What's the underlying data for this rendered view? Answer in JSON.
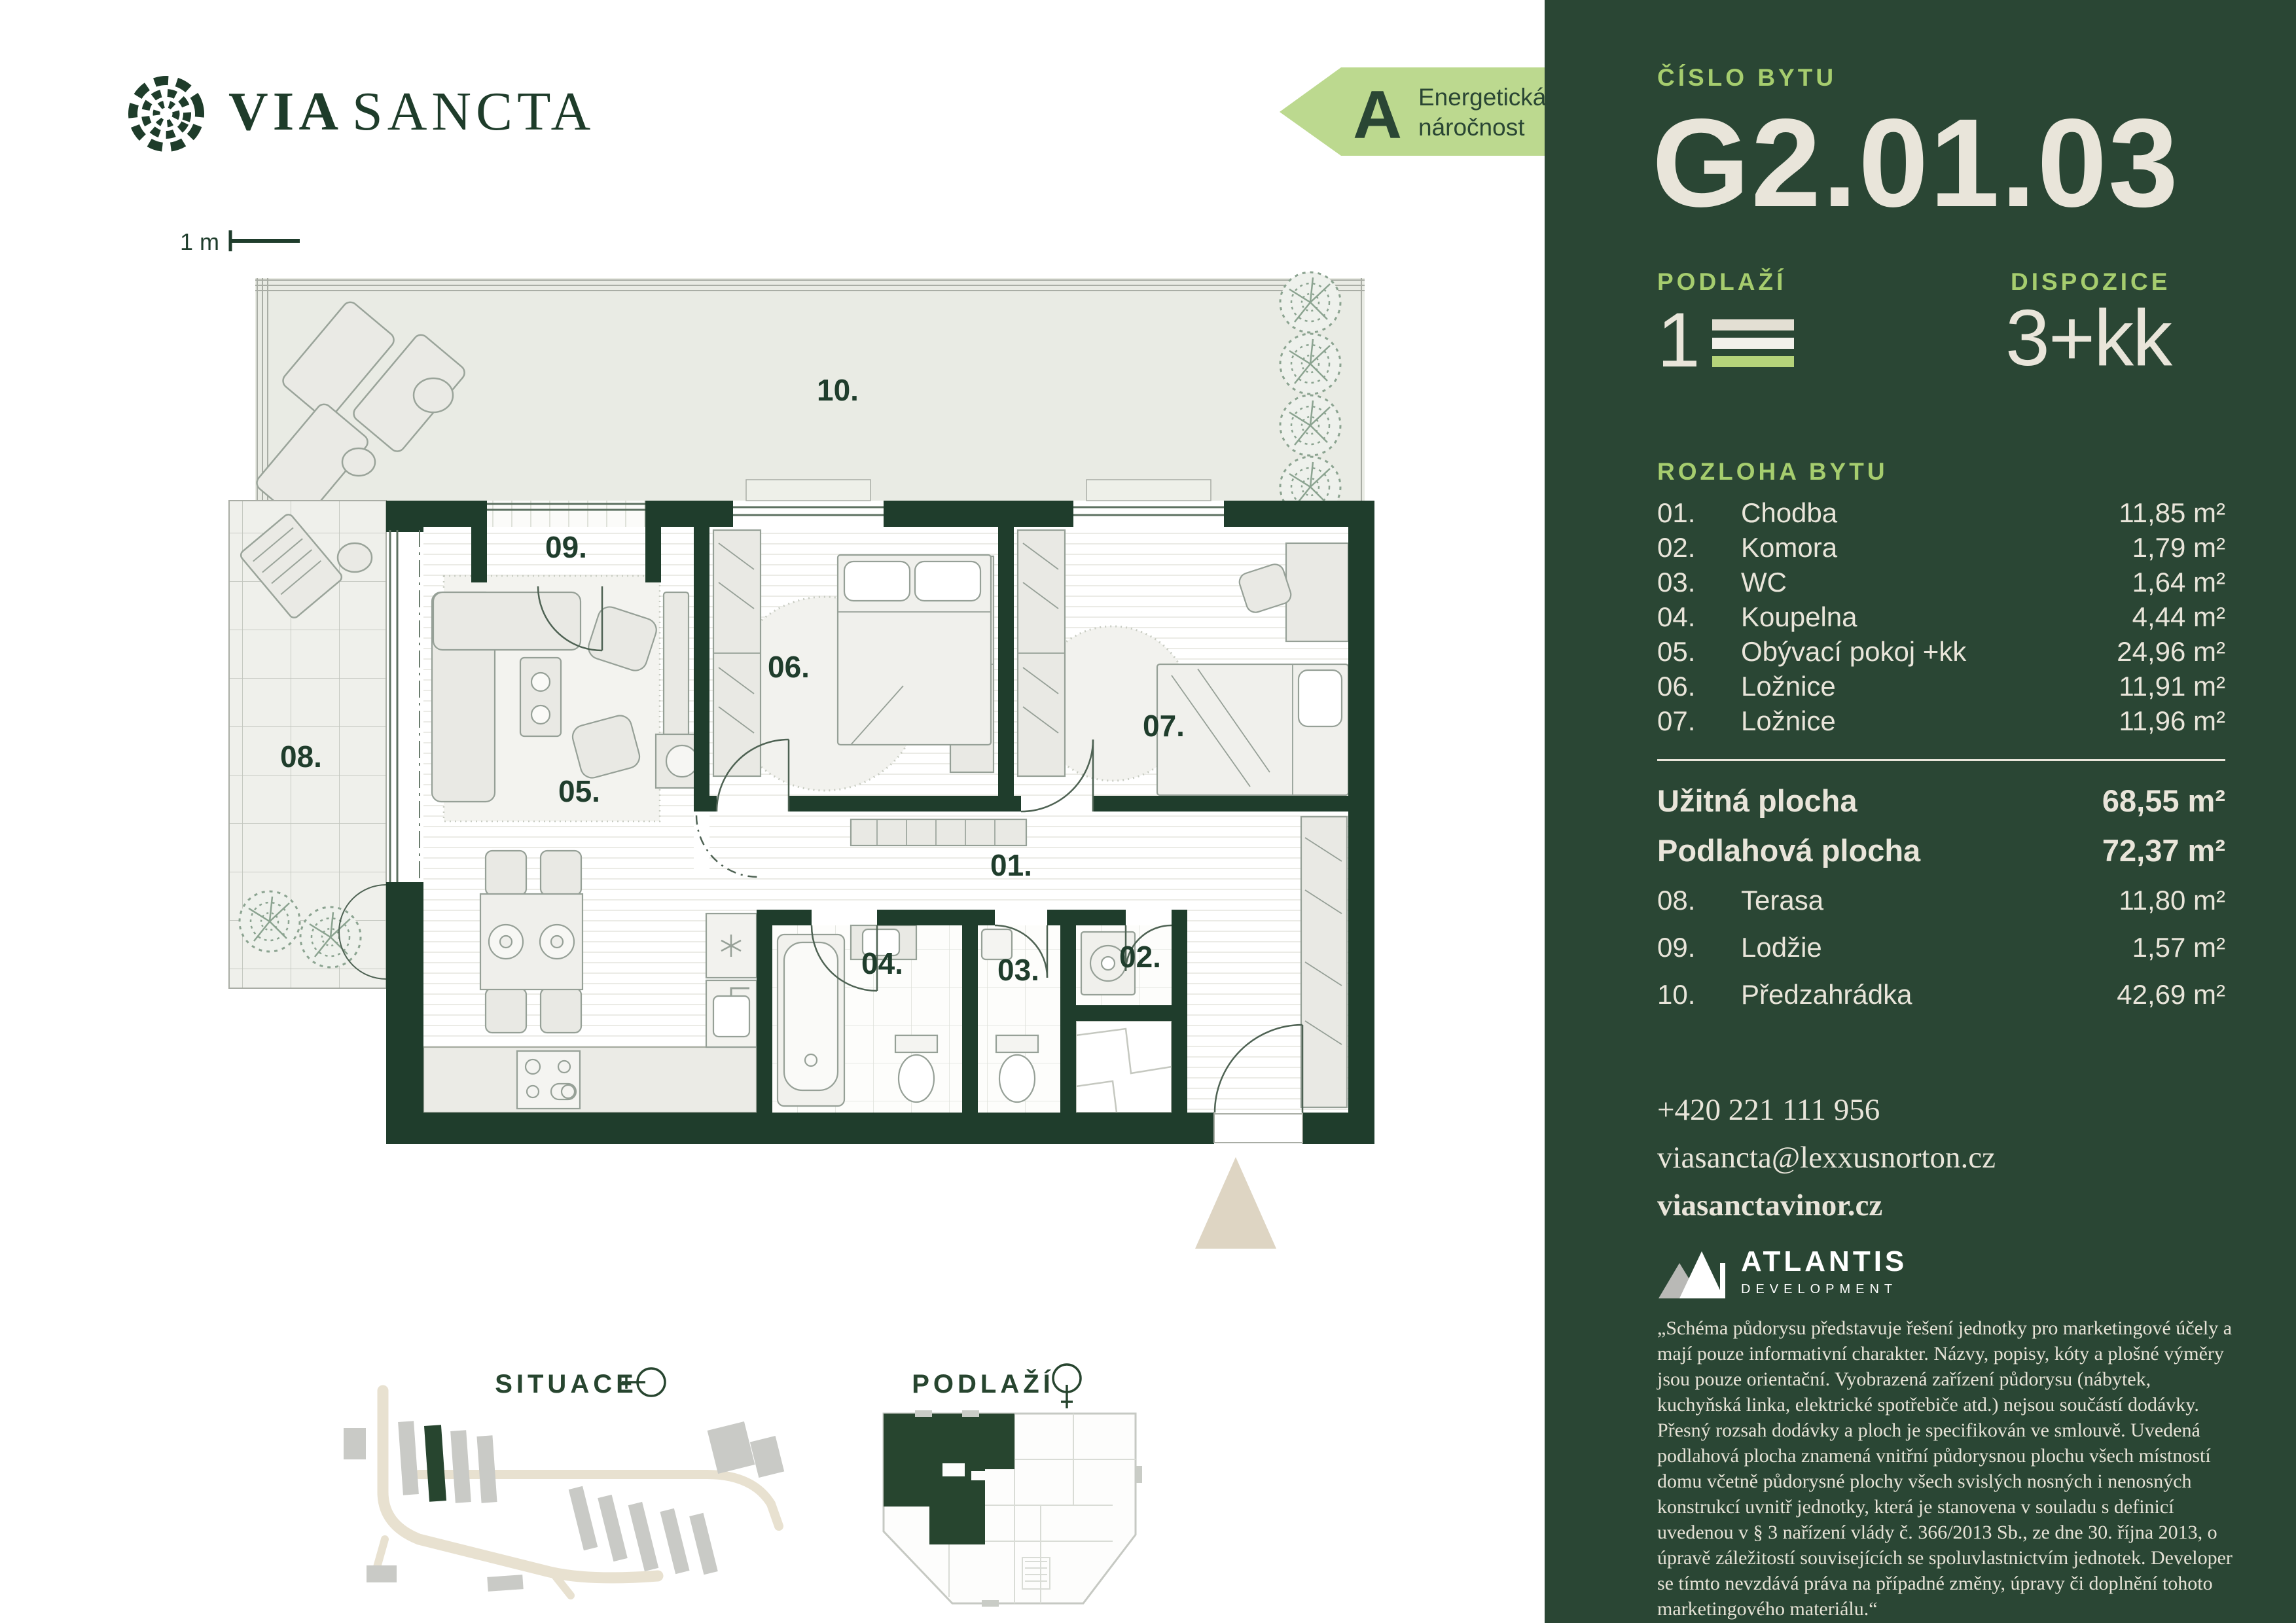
{
  "brand": {
    "word1": "VIA",
    "word2": "SANCTA"
  },
  "energy": {
    "grade": "A",
    "line1": "Energetická",
    "line2": "náročnost"
  },
  "scale_bar": "1 m",
  "plan": {
    "l01": "01.",
    "l02": "02.",
    "l03": "03.",
    "l04": "04.",
    "l05": "05.",
    "l06": "06.",
    "l07": "07.",
    "l08": "08.",
    "l09": "09.",
    "l10": "10."
  },
  "sections": {
    "situace": "SITUACE",
    "podlazi": "PODLAŽÍ"
  },
  "panel": {
    "unit_label": "ČÍSLO BYTU",
    "unit_number": "G2.01.03",
    "floor_label": "PODLAŽÍ",
    "floor_value": "1",
    "layout_label": "DISPOZICE",
    "layout_value": "3+kk",
    "area_label": "ROZLOHA BYTU",
    "rooms": [
      {
        "num": "01.",
        "name": "Chodba",
        "area": "11,85 m²"
      },
      {
        "num": "02.",
        "name": "Komora",
        "area": "1,79 m²"
      },
      {
        "num": "03.",
        "name": "WC",
        "area": "1,64 m²"
      },
      {
        "num": "04.",
        "name": "Koupelna",
        "area": "4,44 m²"
      },
      {
        "num": "05.",
        "name": "Obývací pokoj +kk",
        "area": "24,96 m²"
      },
      {
        "num": "06.",
        "name": "Ložnice",
        "area": "11,91 m²"
      },
      {
        "num": "07.",
        "name": "Ložnice",
        "area": "11,96 m²"
      }
    ],
    "usable": {
      "label": "Užitná plocha",
      "value": "68,55 m²"
    },
    "floor_area": {
      "label": "Podlahová plocha",
      "value": "72,37 m²"
    },
    "exterior": [
      {
        "num": "08.",
        "name": "Terasa",
        "area": "11,80 m²"
      },
      {
        "num": "09.",
        "name": "Lodžie",
        "area": "1,57 m²"
      },
      {
        "num": "10.",
        "name": "Předzahrádka",
        "area": "42,69 m²"
      }
    ],
    "contact": {
      "phone": "+420 221 111 956",
      "email": "viasancta@lexxusnorton.cz",
      "web": "viasanctavinor.cz"
    },
    "developer": {
      "name": "ATLANTIS",
      "subtitle": "DEVELOPMENT"
    },
    "disclaimer": "„Schéma půdorysu představuje řešení jednotky pro marketingové účely a mají pouze informativní charakter. Názvy, popisy, kóty a plošné výměry jsou pouze orientační. Vyobrazená zařízení půdorysu (nábytek, kuchyňská linka, elektrické spotřebiče atd.) nejsou součástí dodávky. Přesný rozsah dodávky a ploch je specifikován ve smlouvě. Uvedená podlahová plocha znamená vnitřní půdorysnou plochu všech místností domu včetně půdorysné plochy všech svislých nosných i nenosných konstrukcí uvnitř jednotky, která je stanovena v souladu s definicí uvedenou v § 3 nařízení vlády č. 366/2013 Sb., ze dne 30. října 2013, o úpravě záležitostí souvisejících se spoluvlastnictvím jednotek. Developer se tímto nevzdává práva na případné změny, úpravy či doplnění tohoto marketingového materiálu.“"
  },
  "colors": {
    "panel_green": "#2a4634",
    "wall_green": "#1f3d2c",
    "accent_green": "#a6cd6e",
    "energy_green": "#bcd98f",
    "cream": "#e9e5da"
  }
}
